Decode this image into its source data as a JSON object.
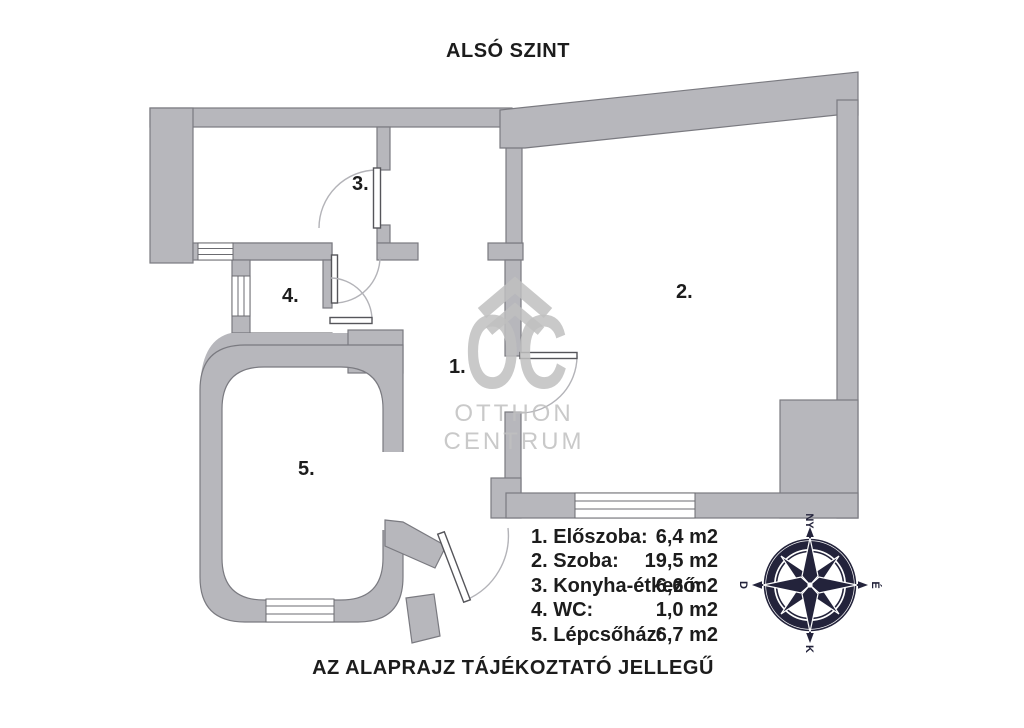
{
  "page": {
    "title": "ALSÓ SZINT",
    "footnote": "AZ ALAPRAJZ TÁJÉKOZTATÓ JELLEGŰ"
  },
  "watermark": {
    "logo_text": "OC",
    "line1": "OTTHON",
    "line2": "CENTRUM"
  },
  "rooms": [
    {
      "plan_label": "1.",
      "legend_label": "1. Előszoba:",
      "area": "6,4 m2"
    },
    {
      "plan_label": "2.",
      "legend_label": "2. Szoba:",
      "area": "19,5 m2"
    },
    {
      "plan_label": "3.",
      "legend_label": "3. Konyha-étkező:",
      "area": "6,6 m2"
    },
    {
      "plan_label": "4.",
      "legend_label": "4. WC:",
      "area": "1,0 m2"
    },
    {
      "plan_label": "5.",
      "legend_label": "5. Lépcsőház:",
      "area": "6,7 m2"
    }
  ],
  "compass": {
    "top": "NY",
    "right": "É",
    "bottom": "K",
    "left": "D"
  },
  "colors": {
    "wall": "#b7b7bc",
    "line": "#7a7a80",
    "ink": "#1c1c1c",
    "wm": "#c0c0c0",
    "compass": "#23233b"
  }
}
